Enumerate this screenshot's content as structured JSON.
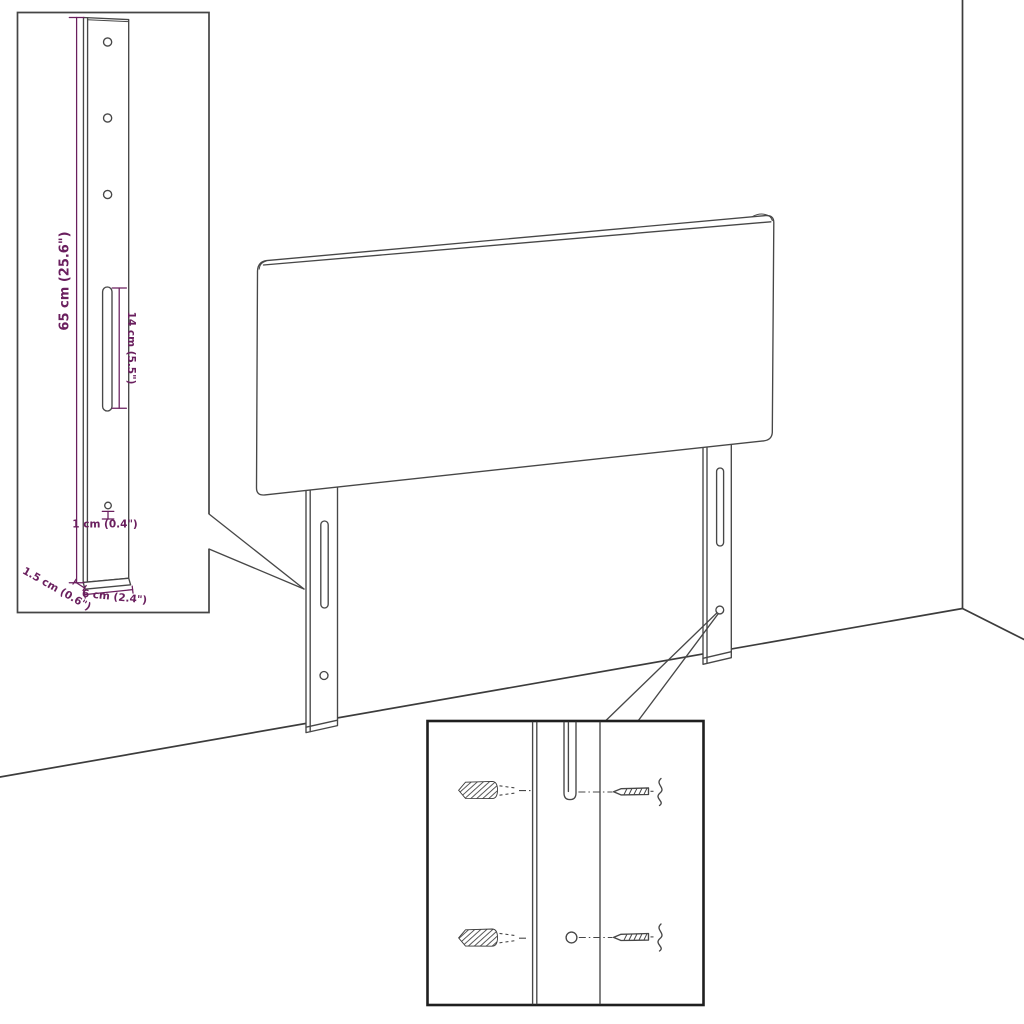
{
  "dimensions": {
    "bracket_height": "65 cm (25.6\")",
    "slot_length": "14 cm (5.5\")",
    "hole_diameter": "1 cm (0.4\")",
    "bracket_depth": "1.5 cm (0.6\")",
    "bracket_width": "6 cm (2.4\")"
  },
  "colors": {
    "dimension_annotation": "#6a1f5e",
    "line_art": "#474747",
    "background": "#ffffff"
  }
}
